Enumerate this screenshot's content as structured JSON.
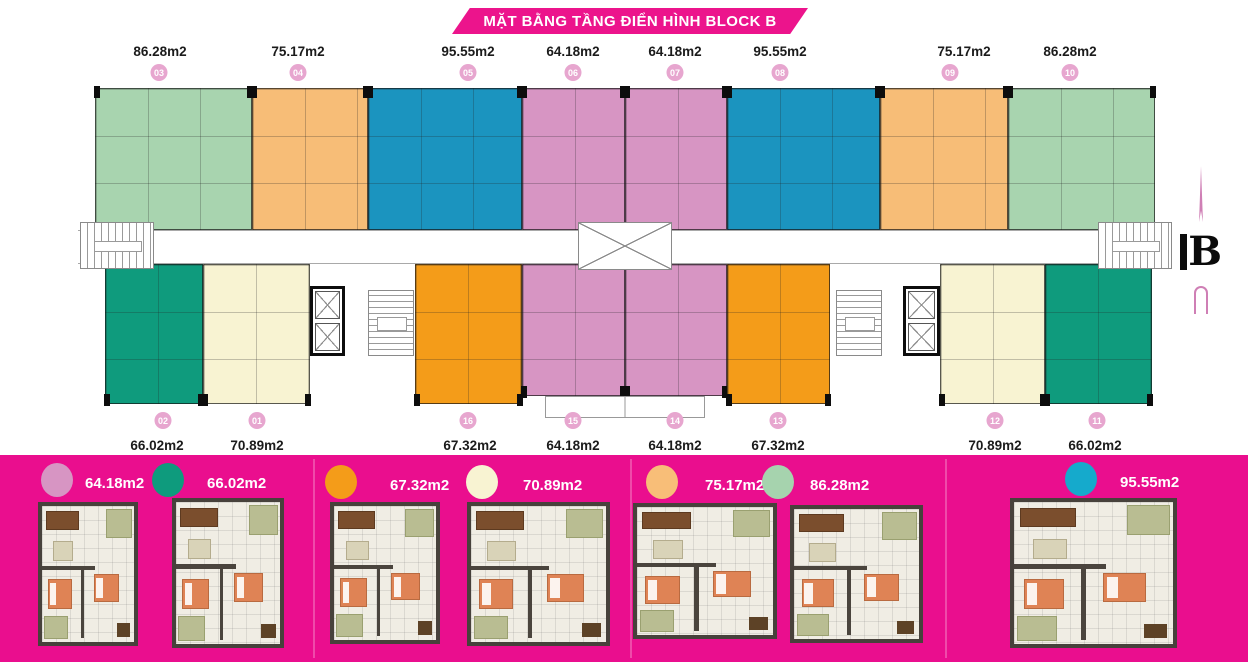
{
  "banner": {
    "title": "MẶT BẰNG TẦNG ĐIỂN HÌNH BLOCK B"
  },
  "compass": {
    "label": "B"
  },
  "plan": {
    "top_units": [
      {
        "no": "03",
        "area": "86.28m2"
      },
      {
        "no": "04",
        "area": "75.17m2"
      },
      {
        "no": "05",
        "area": "95.55m2"
      },
      {
        "no": "06",
        "area": "64.18m2"
      },
      {
        "no": "07",
        "area": "64.18m2"
      },
      {
        "no": "08",
        "area": "95.55m2"
      },
      {
        "no": "09",
        "area": "75.17m2"
      },
      {
        "no": "10",
        "area": "86.28m2"
      }
    ],
    "bottom_units": [
      {
        "no": "02",
        "area": "66.02m2"
      },
      {
        "no": "01",
        "area": "70.89m2"
      },
      {
        "no": "16",
        "area": "67.32m2"
      },
      {
        "no": "15",
        "area": "64.18m2"
      },
      {
        "no": "14",
        "area": "64.18m2"
      },
      {
        "no": "13",
        "area": "67.32m2"
      },
      {
        "no": "12",
        "area": "70.89m2"
      },
      {
        "no": "11",
        "area": "66.02m2"
      }
    ]
  },
  "legend": {
    "items": [
      {
        "area": "64.18m2",
        "color": "#D795C3"
      },
      {
        "area": "66.02m2",
        "color": "#0E9B7D"
      },
      {
        "area": "67.32m2",
        "color": "#F49C19"
      },
      {
        "area": "70.89m2",
        "color": "#F8F3D2"
      },
      {
        "area": "75.17m2",
        "color": "#F8BE78"
      },
      {
        "area": "86.28m2",
        "color": "#A6D3AE"
      },
      {
        "area": "95.55m2",
        "color": "#1B94BF"
      }
    ]
  },
  "colors": {
    "banner_pink": "#EC148C",
    "band_pink": "#EA0E8E",
    "badge_pink": "#E7A6CF"
  }
}
